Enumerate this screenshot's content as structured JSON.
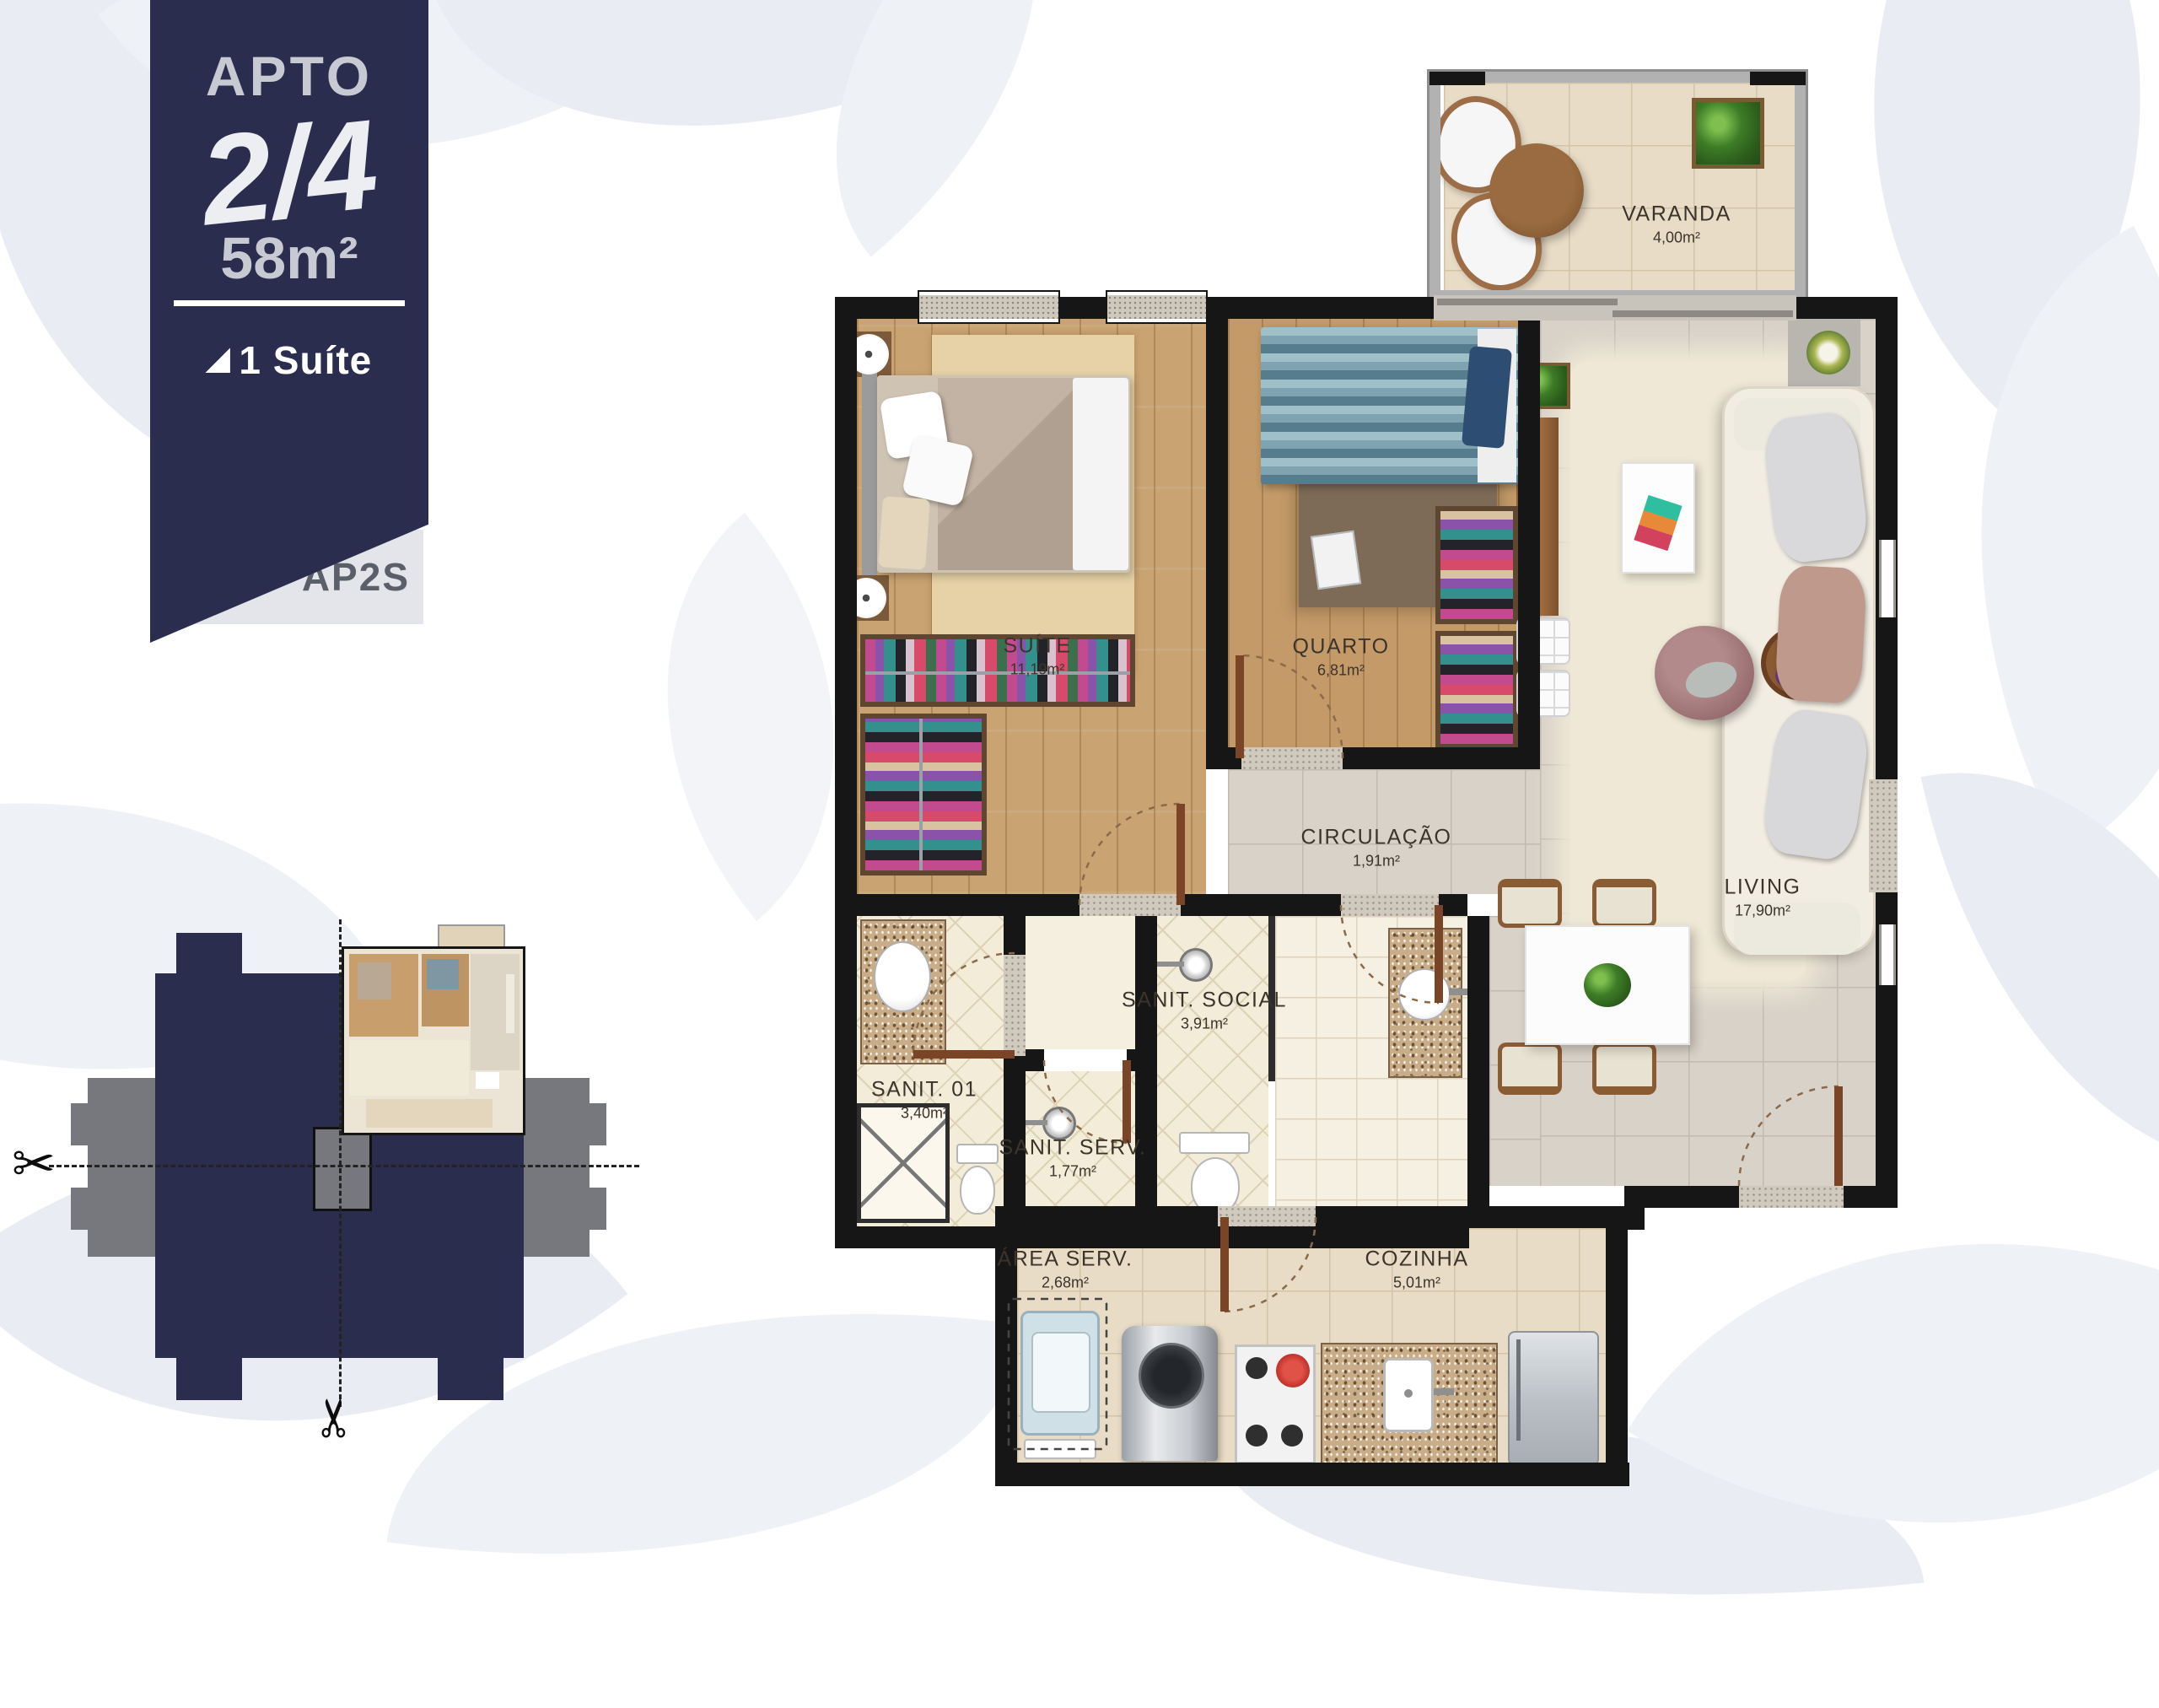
{
  "badge": {
    "title": "APTO",
    "fraction": "2/4",
    "area": "58m²",
    "feature_icon": "◢",
    "feature": "1 Suíte",
    "code": "AP2S"
  },
  "rooms": [
    {
      "id": "varanda",
      "name": "VARANDA",
      "area": "4,00m²"
    },
    {
      "id": "suite",
      "name": "SUÍTE",
      "area": "11,19m²"
    },
    {
      "id": "quarto",
      "name": "QUARTO",
      "area": "6,81m²"
    },
    {
      "id": "circulacao",
      "name": "CIRCULAÇÃO",
      "area": "1,91m²"
    },
    {
      "id": "living",
      "name": "LIVING",
      "area": "17,90m²"
    },
    {
      "id": "sanit_social",
      "name": "SANIT. SOCIAL",
      "area": "3,91m²"
    },
    {
      "id": "sanit_01",
      "name": "SANIT. 01",
      "area": "3,40m²"
    },
    {
      "id": "sanit_serv",
      "name": "SANIT. SERV.",
      "area": "1,77m²"
    },
    {
      "id": "area_serv",
      "name": "ÁREA SERV.",
      "area": "2,68m²"
    },
    {
      "id": "cozinha",
      "name": "COZINHA",
      "area": "5,01m²"
    }
  ],
  "keyplan": {
    "scissors_icon": "✂"
  },
  "colors": {
    "navy": "#2b2d4f",
    "badge_text": "#c7cad3",
    "keyplan_gray": "#77787d",
    "wall": "#161616",
    "wood_floor": "#c9a372",
    "tile_floor": "#d9d2c8",
    "leaf_bg": "#e9ecf2"
  }
}
